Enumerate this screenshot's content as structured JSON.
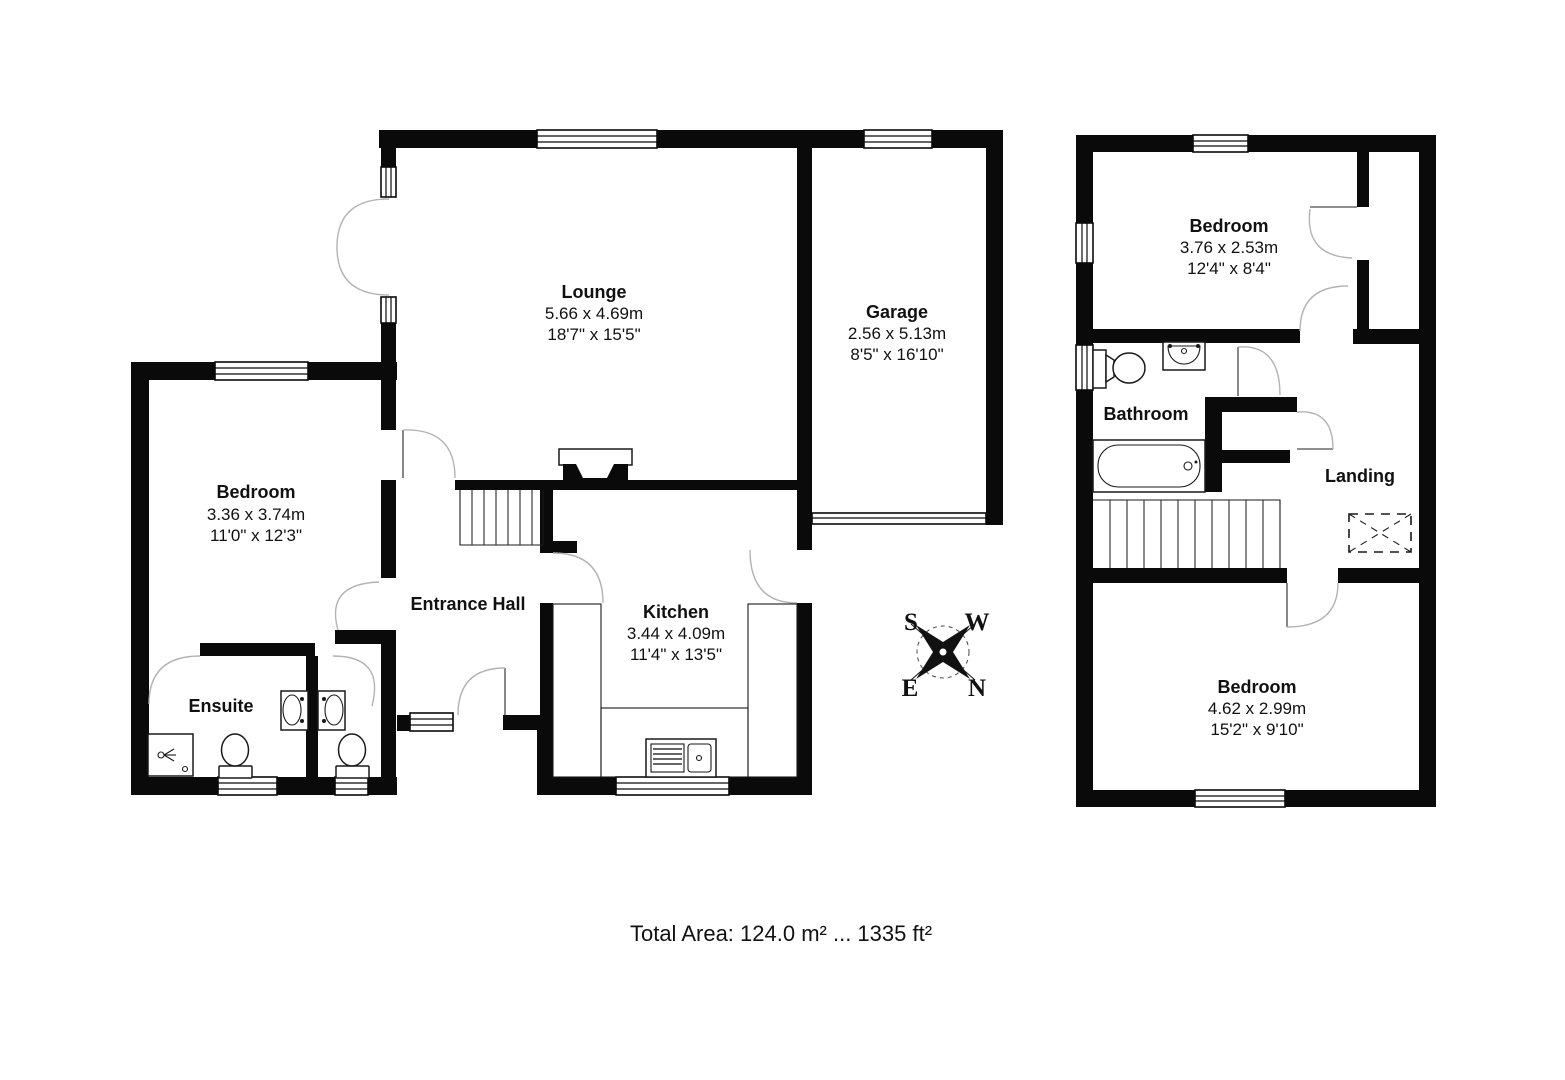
{
  "ground_floor": {
    "lounge": {
      "name": "Lounge",
      "metric": "5.66 x 4.69m",
      "imperial": "18'7\" x 15'5\""
    },
    "garage": {
      "name": "Garage",
      "metric": "2.56 x 5.13m",
      "imperial": "8'5\" x 16'10\""
    },
    "bedroom": {
      "name": "Bedroom",
      "metric": "3.36 x 3.74m",
      "imperial": "11'0\" x 12'3\""
    },
    "kitchen": {
      "name": "Kitchen",
      "metric": "3.44 x 4.09m",
      "imperial": "11'4\" x 13'5\""
    },
    "entrance_hall": {
      "name": "Entrance Hall"
    },
    "ensuite": {
      "name": "Ensuite"
    }
  },
  "first_floor": {
    "bedroom_front": {
      "name": "Bedroom",
      "metric": "3.76 x 2.53m",
      "imperial": "12'4\" x 8'4\""
    },
    "bathroom": {
      "name": "Bathroom"
    },
    "landing": {
      "name": "Landing"
    },
    "bedroom_rear": {
      "name": "Bedroom",
      "metric": "4.62 x 2.99m",
      "imperial": "15'2\" x 9'10\""
    }
  },
  "compass": {
    "north": "N",
    "south": "S",
    "east": "E",
    "west": "W"
  },
  "footer": {
    "total_area": "Total Area: 124.0 m² ... 1335 ft²"
  },
  "colors": {
    "wall": "#0a0a0a",
    "background": "#ffffff",
    "door_arc": "#b3b3b3"
  }
}
